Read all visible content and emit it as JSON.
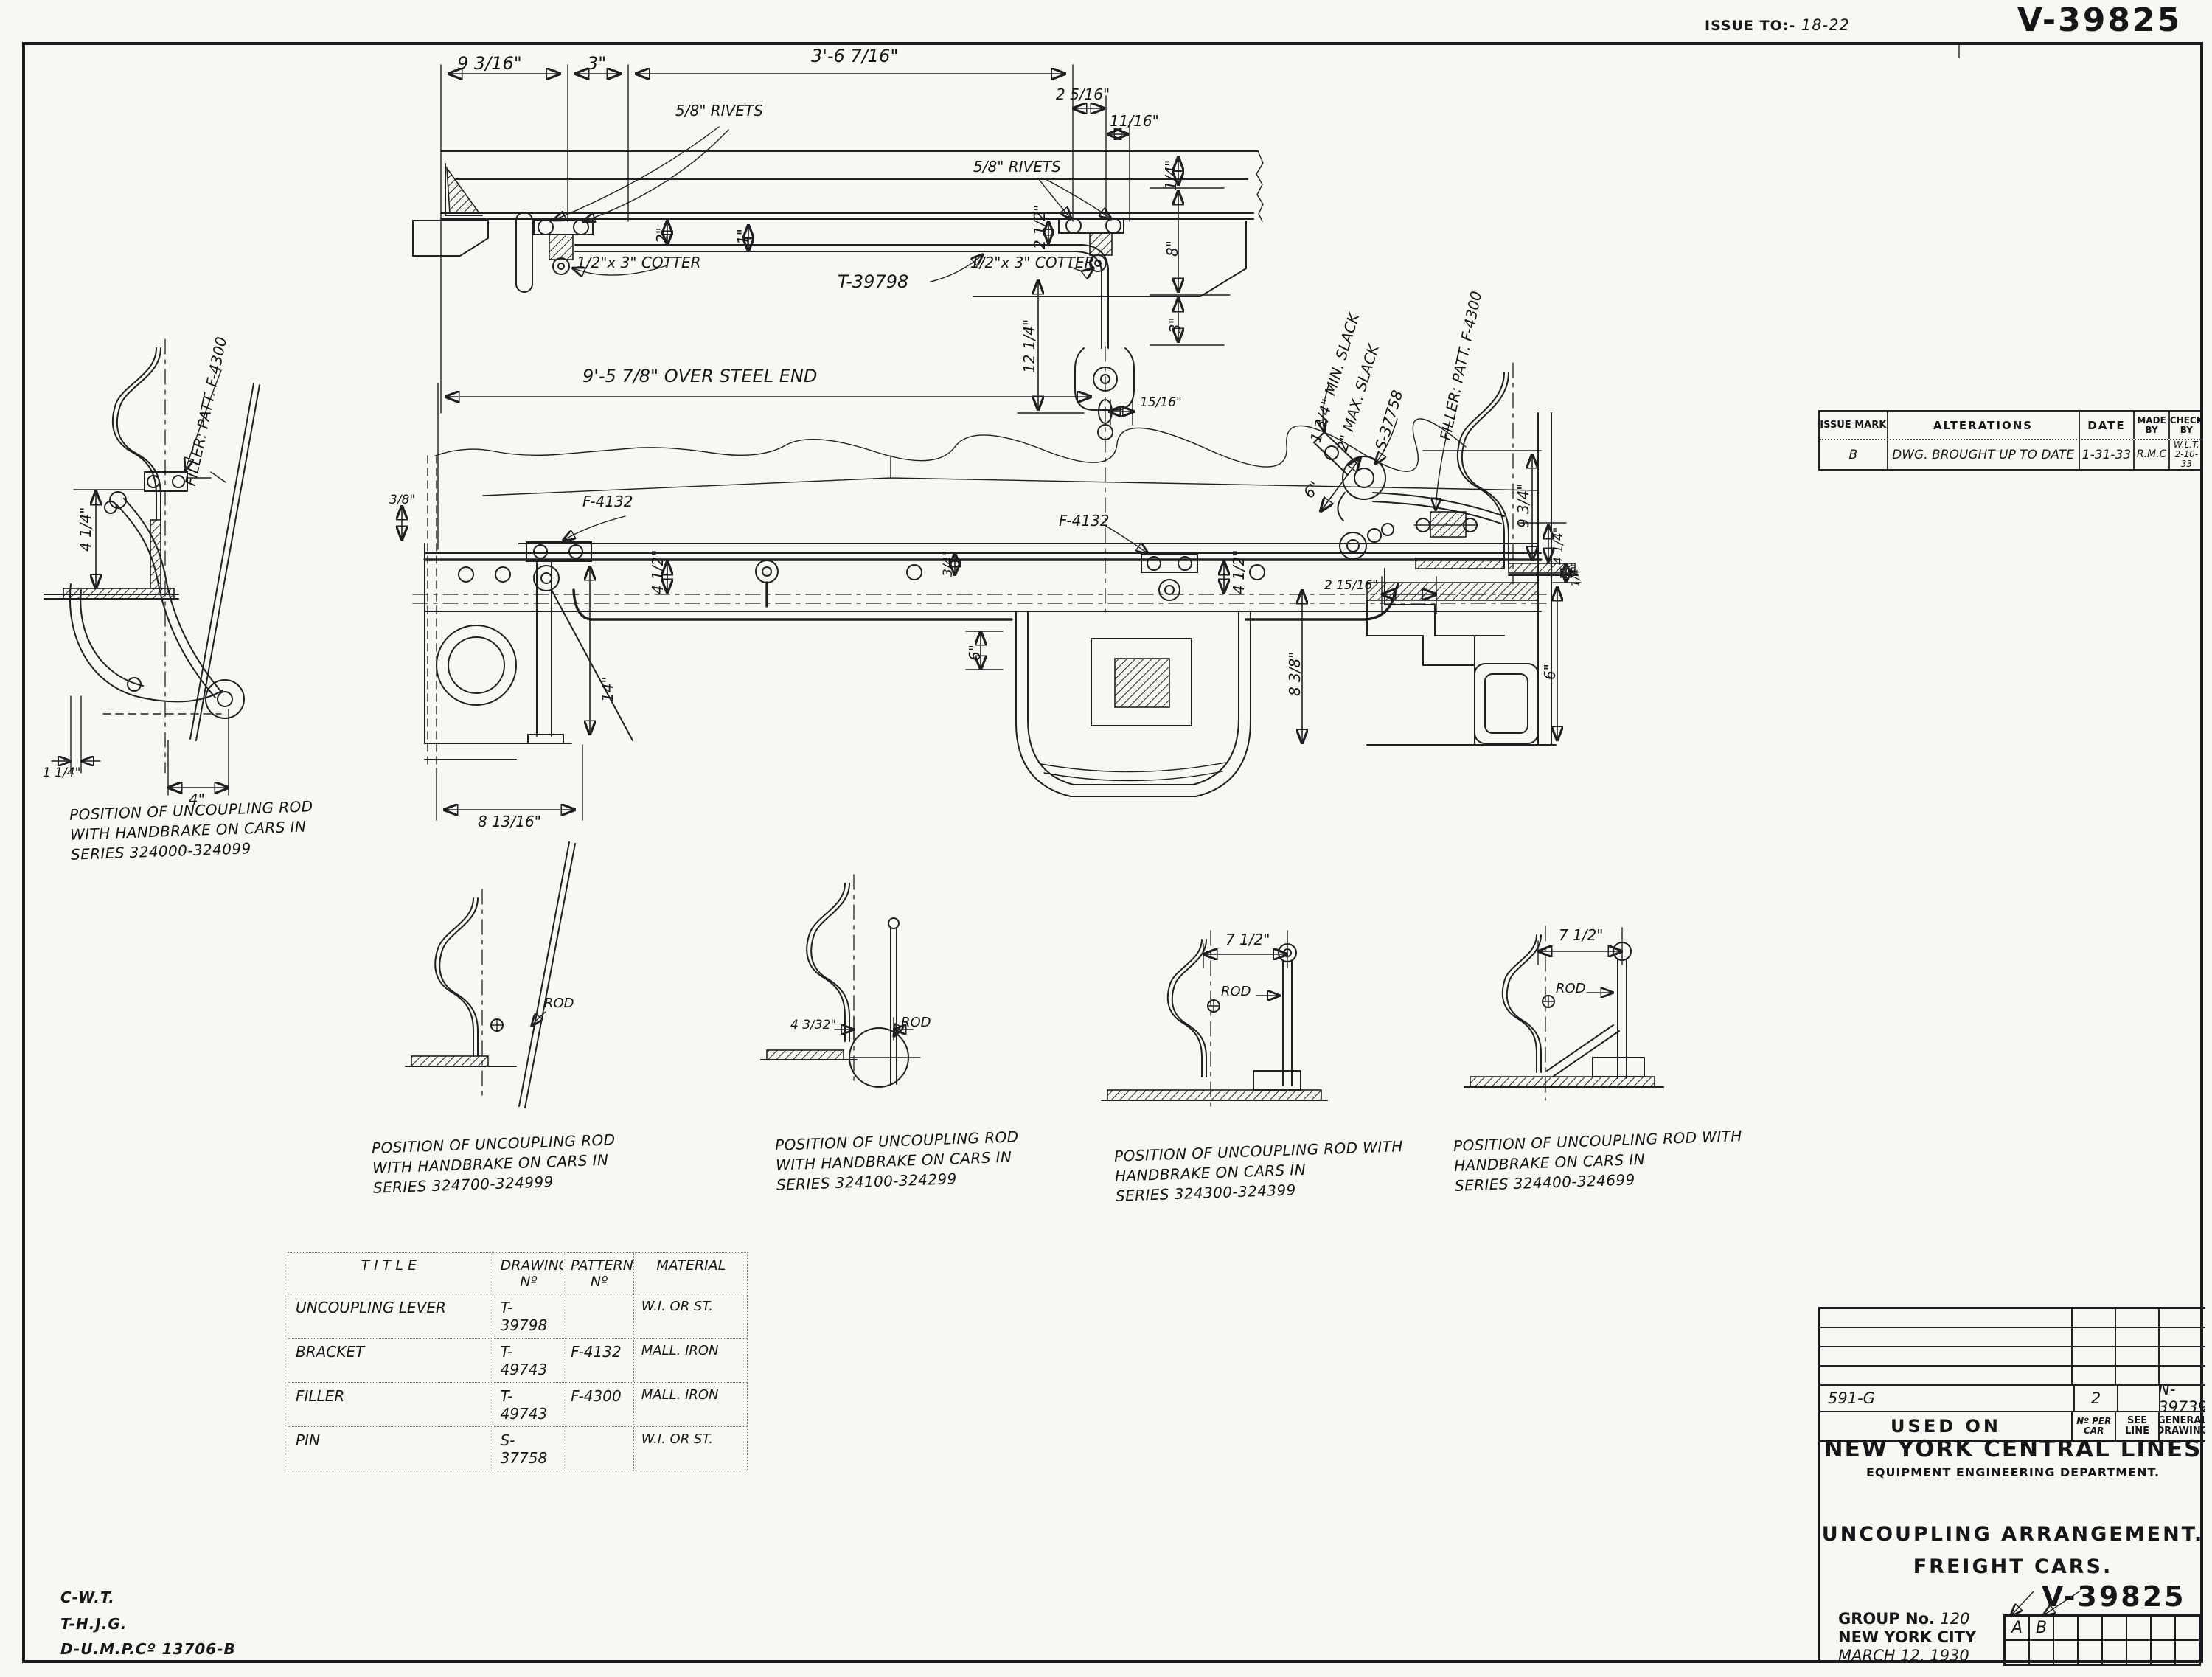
{
  "hdr": {
    "issue_to_label": "ISSUE TO:-",
    "issue_to_value": "18-22",
    "number": "V-39825"
  },
  "alt": {
    "h_mark": "ISSUE MARK",
    "h_alterations": "ALTERATIONS",
    "h_date": "DATE",
    "h_made": "MADE BY",
    "h_check": "CHECK BY",
    "r_mark": "B",
    "r_text": "DWG. BROUGHT UP TO DATE",
    "r_date": "1-31-33",
    "r_made": "R.M.C",
    "r_check1": "W.L.T.",
    "r_check2": "2-10-33"
  },
  "dims": {
    "d1": "9 3/16\"",
    "d2": "3\"",
    "d3": "3'-6 7/16\"",
    "d4": "2 5/16\"",
    "d5": "11/16\"",
    "d6": "2\"",
    "d7": "1\"",
    "d8": "2 1/2\"",
    "d9": "1/4\"",
    "d10": "8\"",
    "d11": "3\"",
    "d12": "12 1/4\"",
    "d13": "15/16\"",
    "d14": "9'-5 7/8\" OVER STEEL END",
    "d15": "3/8\"",
    "d16": "4 1/2\"",
    "d17": "4 1/2\"",
    "d18": "3/4\"",
    "d19": "6\"",
    "d20": "14\"",
    "d21": "8 13/16\"",
    "d22": "8 3/8\"",
    "d23": "2 15/16\"",
    "d24": "6\"",
    "d25": "9 3/4\"",
    "d26": "4 1/4\"",
    "d27": "1/4\"",
    "d28": "6\"",
    "d29": "4 1/4\"",
    "d30": "1 1/4\"",
    "d31": "4\"",
    "d32": "4 3/32\"",
    "d33": "7 1/2\"",
    "d34": "7 1/2\""
  },
  "lbl": {
    "rivets_l": "5/8\" RIVETS",
    "rivets_r": "5/8\" RIVETS",
    "cotter_l": "1/2\"x 3\" COTTER",
    "cotter_r": "1/2\"x 3\" COTTER",
    "t39798": "T-39798",
    "f4132_l": "F-4132",
    "f4132_r": "F-4132",
    "min_slack": "1 3/4\" MIN. SLACK",
    "max_slack": "2\" MAX. SLACK",
    "s37758": "S-37758",
    "filler_r": "FILLER: PATT. F-4300",
    "filler_l": "FILLER: PATT. F-4300",
    "rod_a": "ROD",
    "rod_b": "ROD",
    "rod_c": "ROD",
    "rod_d": "ROD"
  },
  "cap": {
    "c1": {
      "l1": "POSITION OF UNCOUPLING ROD",
      "l2": "WITH HANDBRAKE ON CARS IN",
      "l3": "SERIES 324000-324099"
    },
    "c2": {
      "l1": "POSITION OF UNCOUPLING ROD",
      "l2": "WITH HANDBRAKE ON CARS IN",
      "l3": "SERIES 324700-324999"
    },
    "c3": {
      "l1": "POSITION OF UNCOUPLING ROD",
      "l2": "WITH HANDBRAKE ON CARS IN",
      "l3": "SERIES 324100-324299"
    },
    "c4": {
      "l1": "POSITION OF UNCOUPLING ROD WITH",
      "l2": "HANDBRAKE ON CARS IN",
      "l3": "SERIES 324300-324399"
    },
    "c5": {
      "l1": "POSITION OF UNCOUPLING ROD WITH",
      "l2": "HANDBRAKE ON CARS IN",
      "l3": "SERIES 324400-324699"
    }
  },
  "pt": {
    "h_title": "TITLE",
    "h_drawing": "DRAWING Nº",
    "h_pattern": "PATTERN Nº",
    "h_material": "MATERIAL",
    "rows": [
      {
        "t": "UNCOUPLING LEVER",
        "d": "T-39798",
        "p": "",
        "m": "W.I. OR ST."
      },
      {
        "t": "BRACKET",
        "d": "T-49743",
        "p": "F-4132",
        "m": "MALL. IRON"
      },
      {
        "t": "FILLER",
        "d": "T-49743",
        "p": "F-4300",
        "m": "MALL. IRON"
      },
      {
        "t": "PIN",
        "d": "S-37758",
        "p": "",
        "m": "W.I. OR ST."
      }
    ]
  },
  "tb": {
    "used_row_line": "591-G",
    "used_row_count": "2",
    "used_row_general": "N-39739",
    "used_on": "USED ON",
    "no_per_car": "Nº PER CAR",
    "see_line": "SEE LINE",
    "general_drawing": "GENERAL DRAWING",
    "company": "NEW YORK CENTRAL LINES",
    "dept": "EQUIPMENT ENGINEERING DEPARTMENT.",
    "title1": "UNCOUPLING ARRANGEMENT.",
    "title2": "FREIGHT CARS.",
    "number": "V-39825",
    "group_label": "GROUP No.",
    "group_value": "120",
    "city": "NEW YORK CITY",
    "date": "MARCH 12, 1930",
    "rev_a": "A",
    "rev_b": "B"
  },
  "notes": {
    "l1": "C-W.T.",
    "l2": "T-H.J.G.",
    "l3": "D-U.M.P.Cº 13706-B"
  }
}
